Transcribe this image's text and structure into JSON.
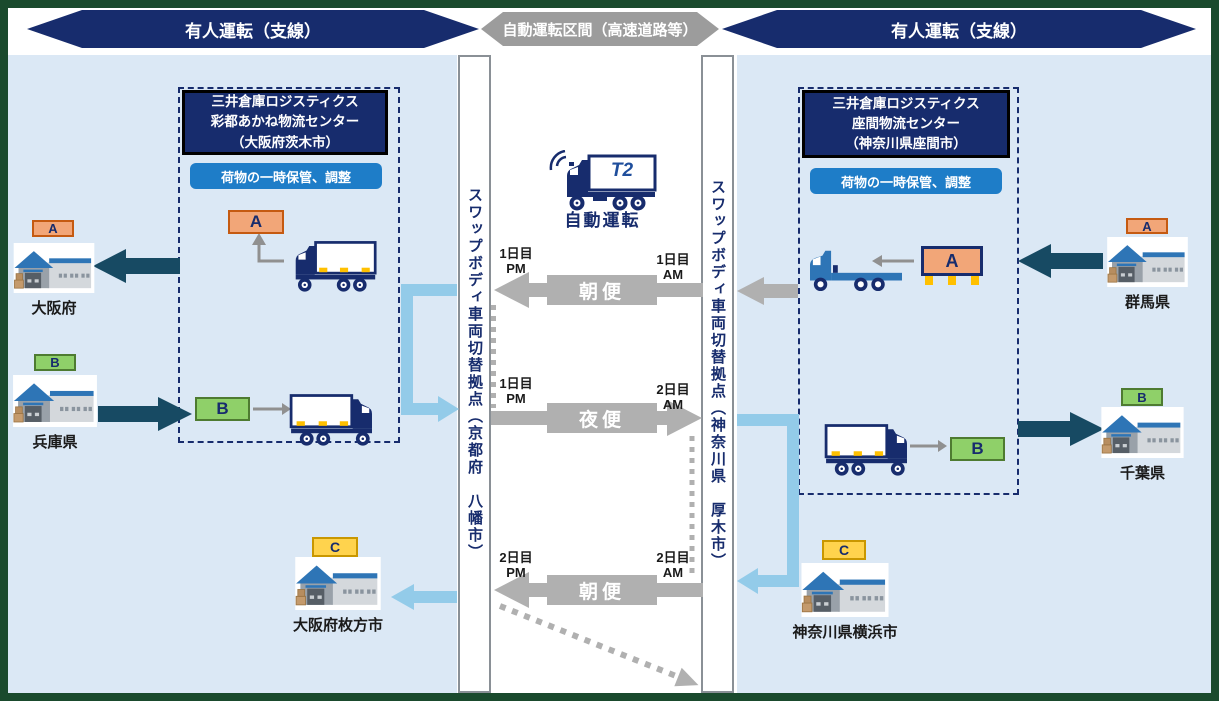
{
  "header": {
    "left": "有人運転（支線）",
    "center": "自動運転区間（高速道路等）",
    "right": "有人運転（支線）"
  },
  "hubs": {
    "left": "スワップボディ車両切替拠点（京都府　八幡市）",
    "right": "スワップボディ車両切替拠点（神奈川県　厚木市）"
  },
  "centers": {
    "left": {
      "title": "三井倉庫ロジスティクス\n彩都あかね物流センター\n（大阪府茨木市）",
      "note": "荷物の一時保管、調整"
    },
    "right": {
      "title": "三井倉庫ロジスティクス\n座間物流センター\n（神奈川県座間市）",
      "note": "荷物の一時保管、調整"
    }
  },
  "auto": {
    "label": "自動運転",
    "logo": "T2"
  },
  "services": {
    "m1": {
      "label": "朝便",
      "time_left": "1日目\nPM",
      "time_right": "1日目\nAM"
    },
    "n1": {
      "label": "夜便",
      "time_left": "1日目\nPM",
      "time_right": "2日目\nAM"
    },
    "m2": {
      "label": "朝便",
      "time_left": "2日目\nPM",
      "time_right": "2日目\nAM"
    }
  },
  "tags": {
    "a": "A",
    "b": "B",
    "c": "C"
  },
  "locations": {
    "osaka": {
      "name": "大阪府",
      "tag": "A"
    },
    "hyogo": {
      "name": "兵庫県",
      "tag": "B"
    },
    "hirakata": {
      "name": "大阪府枚方市",
      "tag": "C"
    },
    "gunma": {
      "name": "群馬県",
      "tag": "A"
    },
    "chiba": {
      "name": "千葉県",
      "tag": "B"
    },
    "yokohama": {
      "name": "神奈川県横浜市",
      "tag": "C"
    }
  },
  "colors": {
    "navy": "#172c6d",
    "frame_green": "#1a4a2d",
    "banner_gray": "#9c9c9c",
    "arrow_gray": "#b0b0b0",
    "panel_blue": "#dbe8f5",
    "note_blue": "#1e7dc8",
    "dark_arrow": "#174a63",
    "light_arrow": "#93cbe9",
    "truck_blue": "#2e75b6",
    "yellow": "#ffc000",
    "tag_a_bg": "#f2a678",
    "tag_a_border": "#c55a11",
    "tag_b_bg": "#8fd069",
    "tag_b_border": "#4e7b31",
    "tag_c_bg": "#ffd34d",
    "tag_c_border": "#c99700"
  }
}
